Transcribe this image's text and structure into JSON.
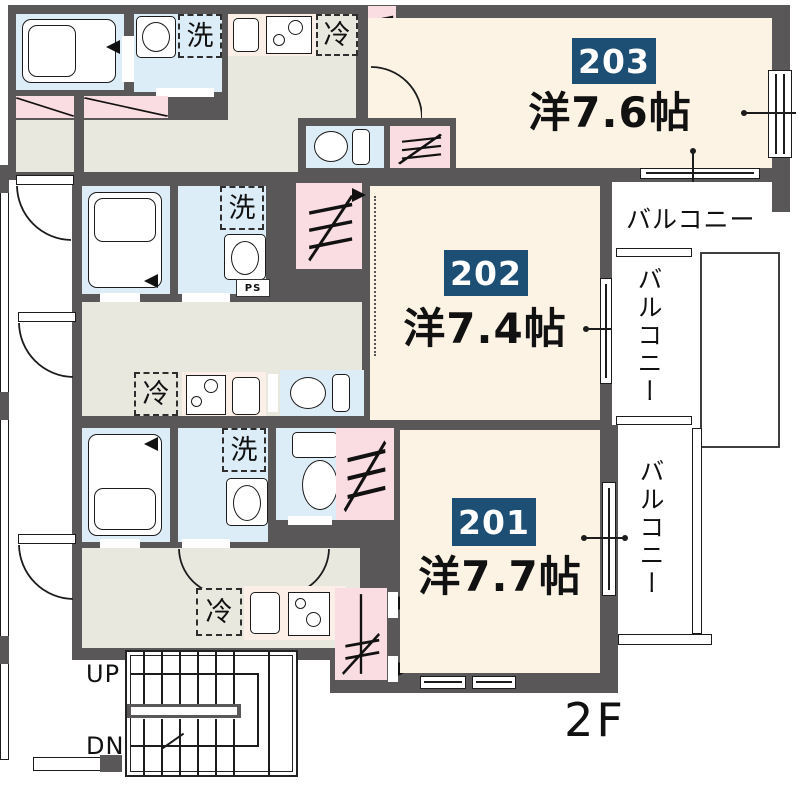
{
  "floor_plan": {
    "floor_label": "2F",
    "units": [
      {
        "id": "203",
        "size_label": "洋7.6帖"
      },
      {
        "id": "202",
        "size_label": "洋7.4帖"
      },
      {
        "id": "201",
        "size_label": "洋7.7帖"
      }
    ],
    "balconies": [
      {
        "label": "バルコニー"
      },
      {
        "label": "バルコニー"
      },
      {
        "label": "バルコニー"
      }
    ],
    "fixtures": {
      "washer": "洗",
      "fridge": "冷",
      "pipe_space": "PS"
    },
    "stairs": {
      "up": "UP",
      "down": "DN"
    },
    "colors": {
      "wall": "#595757",
      "room": "#fdf3e5",
      "wet_area": "#dcedf8",
      "hall": "#e9e8df",
      "closet": "#fadde3",
      "counter": "#fcefe7",
      "badge_bg": "#1d4e73",
      "badge_text": "#ffffff"
    }
  }
}
